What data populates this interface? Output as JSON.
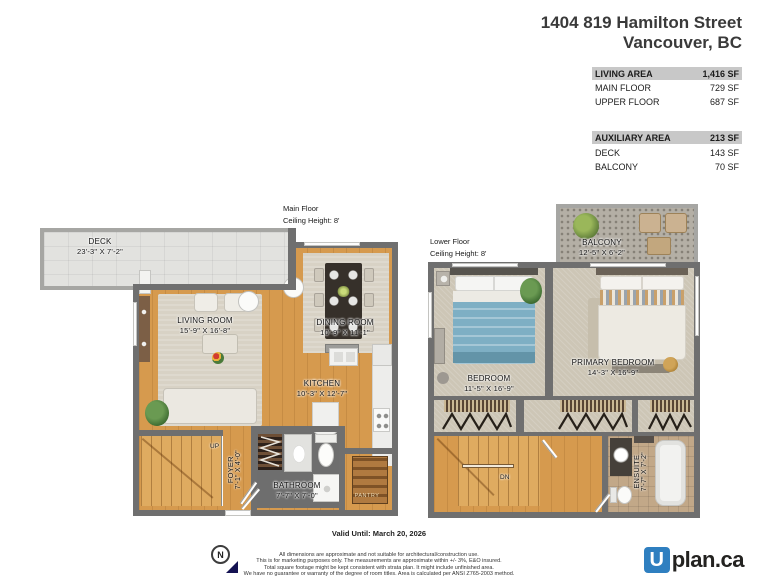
{
  "header": {
    "address_line1": "1404 819 Hamilton Street",
    "address_line2": "Vancouver, BC"
  },
  "area_summary": {
    "living": {
      "label": "LIVING AREA",
      "value": "1,416 SF",
      "rows": [
        {
          "label": "MAIN FLOOR",
          "value": "729 SF"
        },
        {
          "label": "UPPER FLOOR",
          "value": "687 SF"
        }
      ]
    },
    "auxiliary": {
      "label": "AUXILIARY AREA",
      "value": "213 SF",
      "rows": [
        {
          "label": "DECK",
          "value": "143 SF"
        },
        {
          "label": "BALCONY",
          "value": "70 SF"
        }
      ]
    }
  },
  "main_floor": {
    "title": "Main Floor",
    "ceiling": "Ceiling Height: 8'",
    "stair_label": "UP",
    "rooms": {
      "deck": {
        "name": "DECK",
        "dims": "23'-3\" X 7'-2\""
      },
      "living_room": {
        "name": "LIVING ROOM",
        "dims": "15'-9\" X 16'-8\""
      },
      "dining_room": {
        "name": "DINING ROOM",
        "dims": "10'-9\" X 11'-1\""
      },
      "kitchen": {
        "name": "KITCHEN",
        "dims": "10'-3\" X 12'-7\""
      },
      "foyer": {
        "name": "FOYER",
        "dims": "7'-1\" X 4'-0\""
      },
      "bathroom": {
        "name": "BATHROOM",
        "dims": "7'-7\" X 7'-0\""
      },
      "pantry": {
        "name": "PANTRY"
      }
    }
  },
  "lower_floor": {
    "title": "Lower Floor",
    "ceiling": "Ceiling Height: 8'",
    "stair_label": "DN",
    "rooms": {
      "balcony": {
        "name": "BALCONY",
        "dims": "12'-5\" X 6'-2\""
      },
      "bedroom": {
        "name": "BEDROOM",
        "dims": "11'-5\" X 16'-9\""
      },
      "primary_bedroom": {
        "name": "PRIMARY BEDROOM",
        "dims": "14'-3\" X 16'-9\""
      },
      "ensuite": {
        "name": "ENSUITE",
        "dims": "7'-7\" X 7'-2\""
      }
    }
  },
  "footer": {
    "valid_until": "Valid Until: March 20, 2026",
    "compass_label": "N",
    "disclaimer": [
      "All dimensions are approximate and not suitable for architectural/construction use.",
      "This is for marketing purposes only. The measurements are approximate within +/- 3%, E&O insured.",
      "Total square footage might be kept consistent with strata plan. It might include unfinished area.",
      "We have no guarantee or warranty of the degree of room titles. Area is calculated per ANSI Z765-2003 method."
    ],
    "logo": {
      "icon_letter": "U",
      "text": "plan.ca"
    }
  },
  "colors": {
    "logo_blue": "#2f7fc0",
    "wood_floor": "#d69a4e",
    "wall_gray": "#6f6f6f",
    "carpet_beige": "#cdc6b6",
    "table_header_bg": "#c8c8c8",
    "blanket_blue": "#7eafc4",
    "compass_navy": "#141252"
  }
}
